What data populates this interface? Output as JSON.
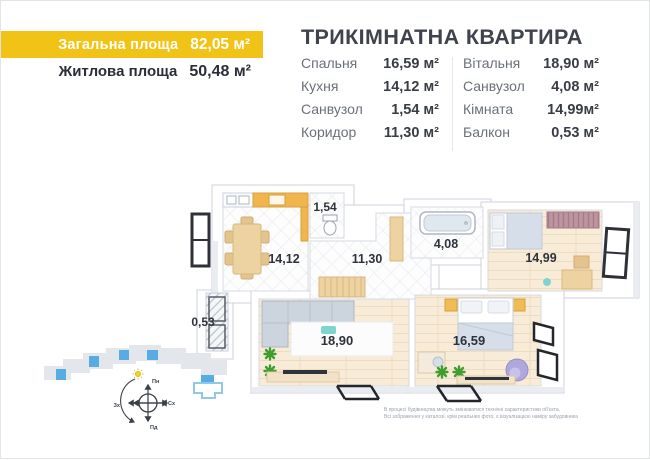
{
  "colors": {
    "accent_yellow": "#F2C317",
    "highlight_blue": "#57ACE3",
    "floor_cream": "#F8ECD8",
    "counter_orange": "#F0B54E",
    "plant_green": "#3F9E2C",
    "text_dark": "#2B2E37",
    "text_gray": "#6A707A"
  },
  "header": {
    "total_area_label": "Загальна площа",
    "total_area_value": "82,05 м²",
    "living_area_label": "Житлова площа",
    "living_area_value": "50,48 м²"
  },
  "title": "ТРИКІМНАТНА КВАРТИРА",
  "room_table": {
    "left": [
      {
        "label": "Спальня",
        "value": "16,59 м²"
      },
      {
        "label": "Кухня",
        "value": "14,12 м²"
      },
      {
        "label": "Санвузол",
        "value": "1,54 м²"
      },
      {
        "label": "Коридор",
        "value": "11,30 м²"
      }
    ],
    "right": [
      {
        "label": "Вітальня",
        "value": "18,90 м²"
      },
      {
        "label": "Санвузол",
        "value": "4,08 м²"
      },
      {
        "label": "Кімната",
        "value": "14,99м²"
      },
      {
        "label": "Балкон",
        "value": "0,53 м²"
      }
    ]
  },
  "floor_plan": {
    "labels": {
      "kitchen": "14,12",
      "wc_small": "1,54",
      "corridor": "11,30",
      "wc_large": "4,08",
      "room": "14,99",
      "balcony": "0,53",
      "living": "18,90",
      "bedroom": "16,59"
    }
  },
  "site_plan": {
    "compass": {
      "north": "Пн",
      "east": "Сх",
      "south": "Пд",
      "west": "Зх"
    }
  },
  "disclaimer": {
    "line1": "В процесі будівництва можуть змінюватися технічні характеристики об'єкта.",
    "line2": "Всі зображення у каталозі, крім реальних фото, є візуалізацією наміру забудовника"
  }
}
